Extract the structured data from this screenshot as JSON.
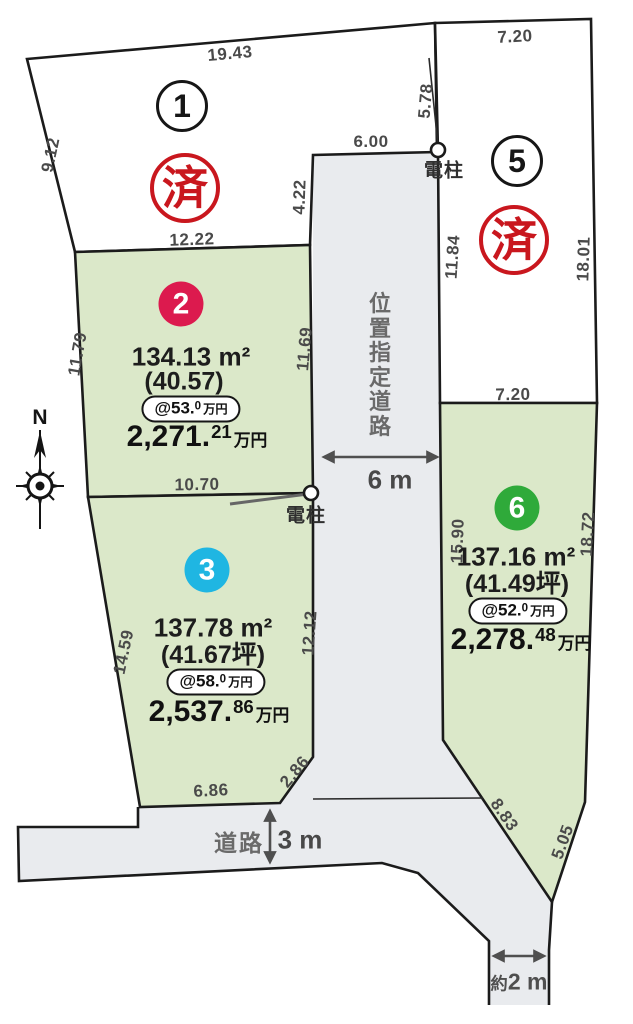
{
  "colors": {
    "plot-green": "#dbe8c9",
    "road-gray": "#e9ebee",
    "outline": "#1b1b1b",
    "dim-text": "#4a4a4a",
    "road-text": "#6a6a6a",
    "arrow-gray": "#4f4f4f",
    "sold-red": "#c9171e",
    "plot2-pink": "#dc1a4e",
    "plot3-cyan": "#1fb6e2",
    "plot6-green": "#2faa3a"
  },
  "compass": {
    "north": "N"
  },
  "poles": {
    "label": "電柱"
  },
  "roads": {
    "designated_road": "位置指定道路",
    "designated_road_width": "6 m",
    "south_road": "道路",
    "south_road_width": "3 m",
    "narrow_road_prefix": "約",
    "narrow_road_width": "2 m"
  },
  "dims": {
    "plot1_top": "19.43",
    "plot1_left": "9.12",
    "plot1_bottom": "12.22",
    "plot1_right": "4.22",
    "road_top": "6.00",
    "pole_span": "5.78",
    "plot5_top": "7.20",
    "plot5_left": "11.84",
    "plot5_right": "18.01",
    "plot2_left": "11.79",
    "plot2_right": "11.69",
    "plot2_bottom": "10.70",
    "plot3_left": "14.59",
    "plot3_right": "12.12",
    "plot3_bottom": "6.86",
    "plot3_chamfer": "2.86",
    "plot6_top": "7.20",
    "plot6_left": "15.90",
    "plot6_right": "18.72",
    "plot6_bottom_left": "8.83",
    "plot6_bottom_right": "5.05"
  },
  "plots": {
    "p1": {
      "number": "1",
      "status": "済"
    },
    "p2": {
      "number": "2",
      "area": "134.13 m²",
      "tsubo": "(40.57)",
      "unit_price": {
        "main": "@53.",
        "sup": "0",
        "unit": "万円"
      },
      "price": {
        "main": "2,271.",
        "sup": "21",
        "unit": "万円"
      }
    },
    "p3": {
      "number": "3",
      "area": "137.78 m²",
      "tsubo": "(41.67坪)",
      "unit_price": {
        "main": "@58.",
        "sup": "0",
        "unit": "万円"
      },
      "price": {
        "main": "2,537.",
        "sup": "86",
        "unit": "万円"
      }
    },
    "p5": {
      "number": "5",
      "status": "済"
    },
    "p6": {
      "number": "6",
      "area": "137.16 m²",
      "tsubo": "(41.49坪)",
      "unit_price": {
        "main": "@52.",
        "sup": "0",
        "unit": "万円"
      },
      "price": {
        "main": "2,278.",
        "sup": "48",
        "unit": "万円"
      }
    }
  }
}
